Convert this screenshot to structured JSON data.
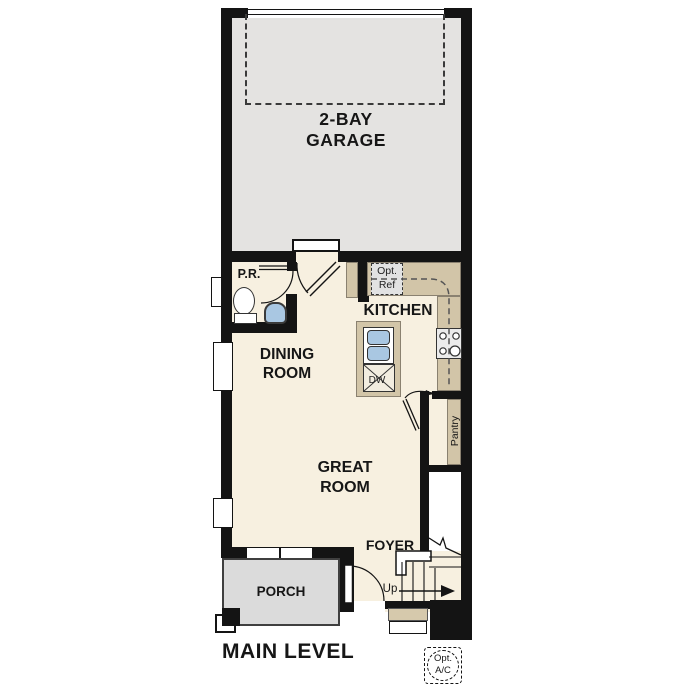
{
  "plan_title": "MAIN LEVEL",
  "rooms": {
    "garage": {
      "label": "2-BAY\nGARAGE"
    },
    "powder_room": {
      "label": "P.R."
    },
    "kitchen": {
      "label": "KITCHEN"
    },
    "dining_room": {
      "label": "DINING\nROOM"
    },
    "great_room": {
      "label": "GREAT\nROOM"
    },
    "pantry": {
      "label": "Pantry"
    },
    "foyer": {
      "label": "FOYER"
    },
    "porch": {
      "label": "PORCH"
    }
  },
  "annotations": {
    "optional_refrigerator": {
      "label": "Opt.\nRef"
    },
    "dishwasher": {
      "label": "DW"
    },
    "stairs_direction": {
      "label": "Up"
    },
    "optional_ac": {
      "label": "Opt.\nA/C"
    }
  },
  "colors": {
    "wall": "#141414",
    "main_floor": "#f7f0e0",
    "garage_floor": "#e4e3e1",
    "porch_floor": "#dbdbdb",
    "counter_tan": "#d2c5a8",
    "fixture_blue": "#a9c7e2",
    "landing_tan": "#d6c9ac",
    "appliance_gray": "#e2e2e2"
  }
}
